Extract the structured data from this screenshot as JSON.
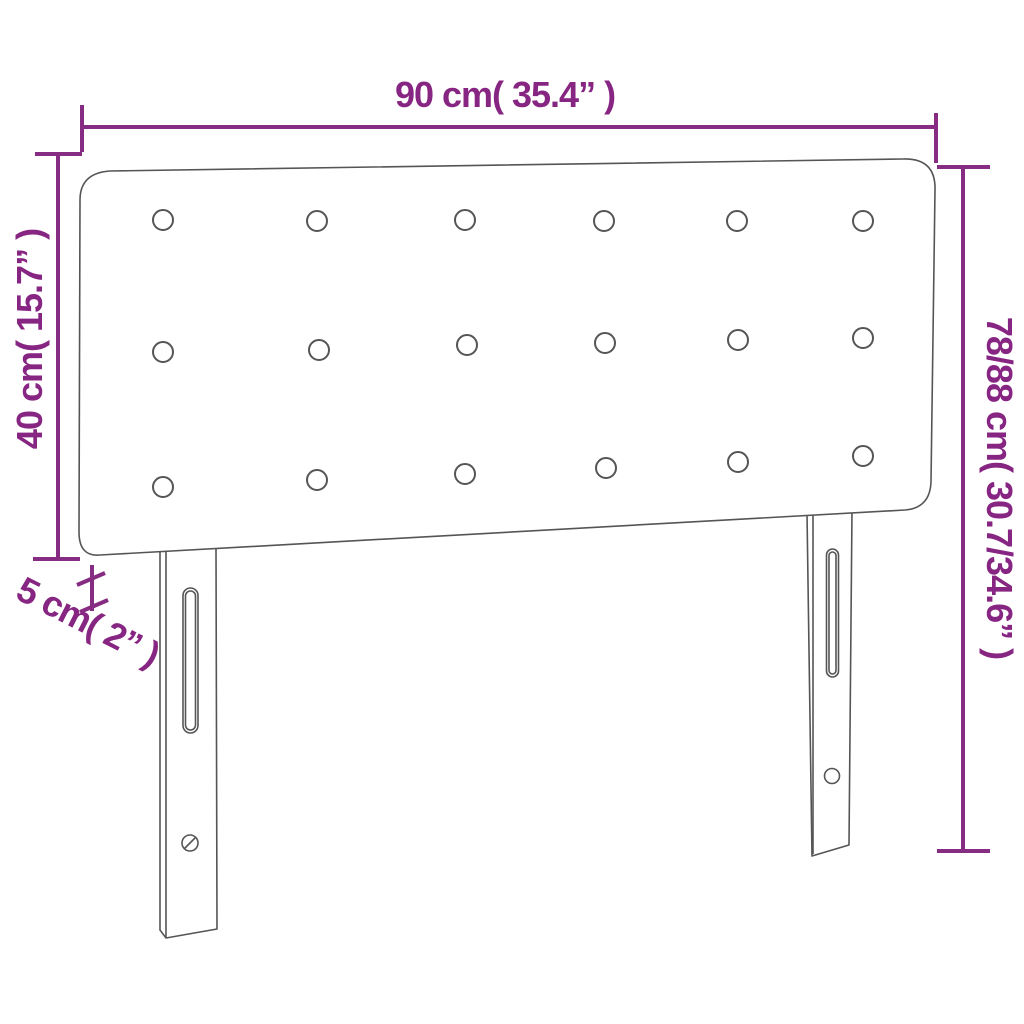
{
  "diagram": {
    "kind": "product-dimension-diagram",
    "subject": "upholstered headboard with two legs and 18 tufted buttons"
  },
  "colors": {
    "accent": "#862c82",
    "text": "#872682",
    "outline": "#555555",
    "background": "#ffffff"
  },
  "labels": {
    "width": "90 cm( 35.4” )",
    "panel_height": "40 cm( 15.7” )",
    "total_height": "78/88 cm( 30.7/34.6” )",
    "depth": "5 cm( 2” )"
  },
  "measurements": {
    "width": {
      "cm": "90",
      "inches": "35.4"
    },
    "panel_height": {
      "cm": "40",
      "inches": "15.7"
    },
    "total_height": {
      "cm": "78/88",
      "inches": "30.7/34.6"
    },
    "depth": {
      "cm": "5",
      "inches": "2"
    }
  },
  "figure": {
    "button_rows": 3,
    "button_cols": 6,
    "legs": 2
  }
}
